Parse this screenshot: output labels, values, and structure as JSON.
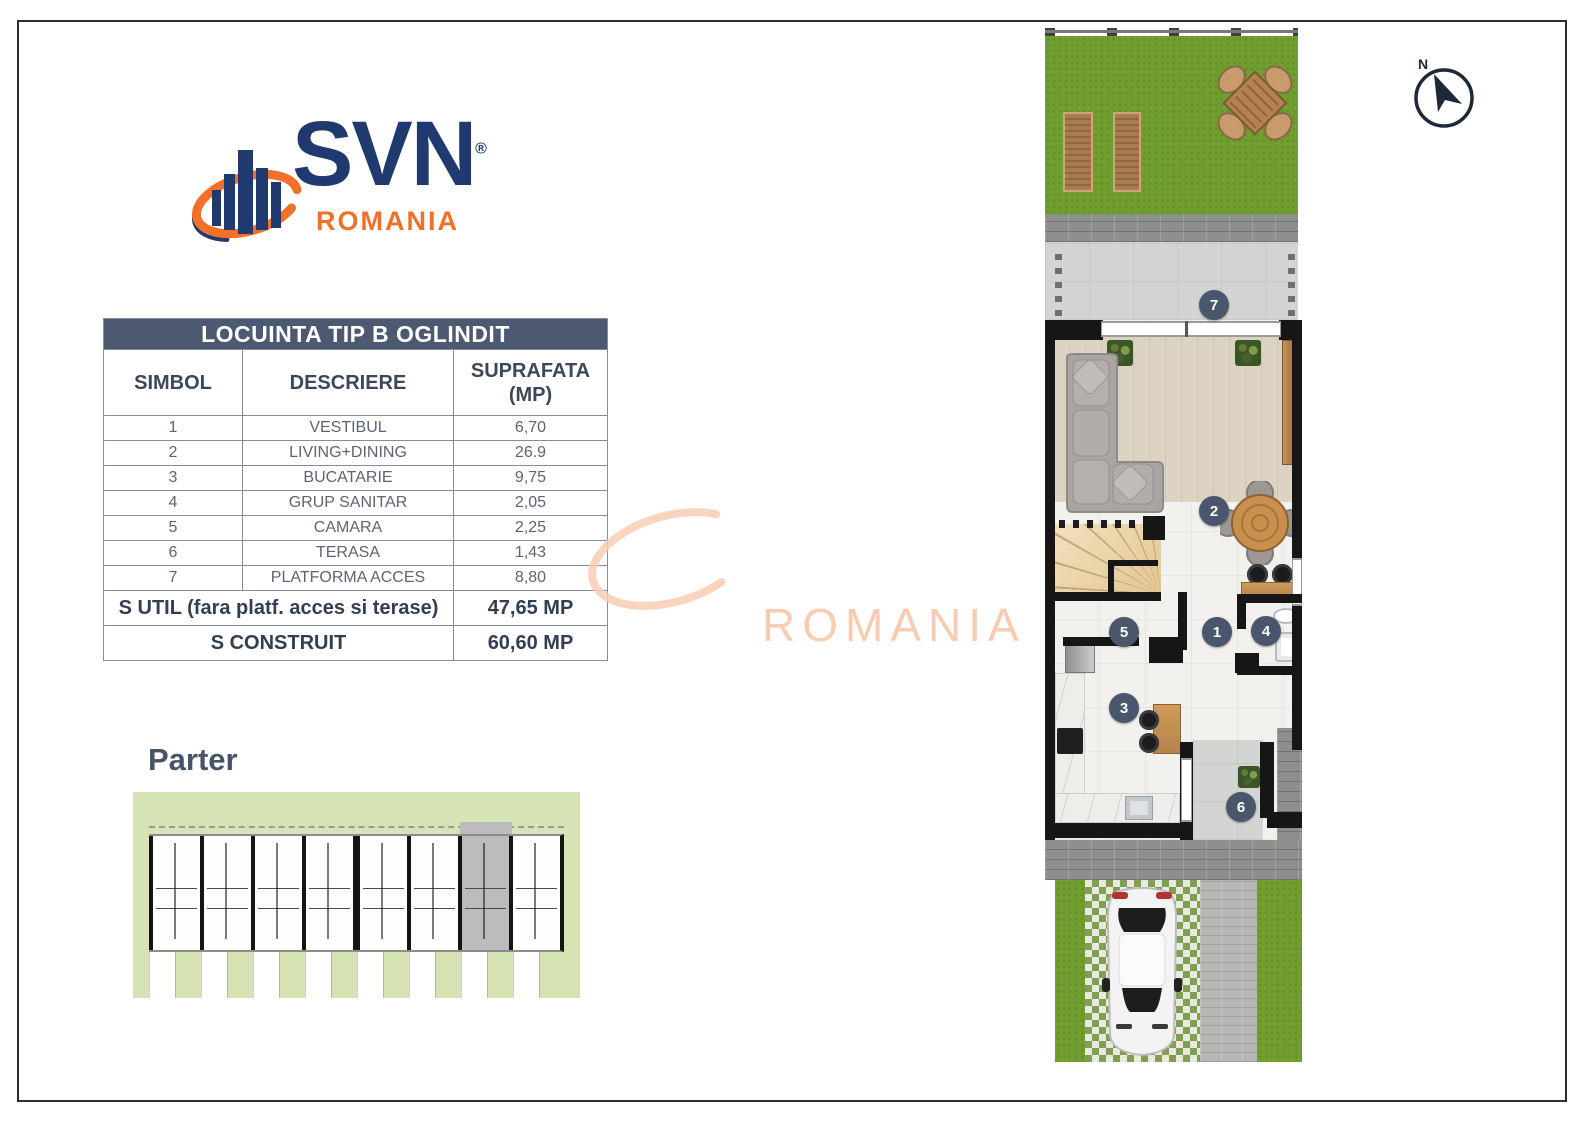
{
  "logo": {
    "brand": "SVN",
    "registered_mark": "®",
    "region": "ROMANIA",
    "navy": "#203a70",
    "orange": "#f2712a"
  },
  "table": {
    "title": "LOCUINTA TIP B OGLINDIT",
    "columns": {
      "c1": "SIMBOL",
      "c2": "DESCRIERE",
      "c3_line1": "SUPRAFATA",
      "c3_line2": "(MP)"
    },
    "rows": [
      {
        "simbol": "1",
        "descriere": "VESTIBUL",
        "suprafata": "6,70"
      },
      {
        "simbol": "2",
        "descriere": "LIVING+DINING",
        "suprafata": "26.9"
      },
      {
        "simbol": "3",
        "descriere": "BUCATARIE",
        "suprafata": "9,75"
      },
      {
        "simbol": "4",
        "descriere": "GRUP SANITAR",
        "suprafata": "2,05"
      },
      {
        "simbol": "5",
        "descriere": "CAMARA",
        "suprafata": "2,25"
      },
      {
        "simbol": "6",
        "descriere": "TERASA",
        "suprafata": "1,43"
      },
      {
        "simbol": "7",
        "descriere": "PLATFORMA ACCES",
        "suprafata": "8,80"
      }
    ],
    "summary": [
      {
        "label": "S UTIL (fara platf. acces si terase)",
        "value": "47,65 MP"
      },
      {
        "label": "S CONSTRUIT",
        "value": "60,60 MP"
      }
    ],
    "header_bg": "#4d5971"
  },
  "floor_label": "Parter",
  "watermark": {
    "text": "ROMANIA",
    "color": "#f8cbb2"
  },
  "compass": {
    "label": "N"
  },
  "floor_plan": {
    "marker_color": "#49566b",
    "markers": [
      {
        "number": "7",
        "x": 169,
        "y": 277
      },
      {
        "number": "2",
        "x": 169,
        "y": 483
      },
      {
        "number": "1",
        "x": 172,
        "y": 604
      },
      {
        "number": "4",
        "x": 221,
        "y": 603
      },
      {
        "number": "5",
        "x": 79,
        "y": 604
      },
      {
        "number": "3",
        "x": 79,
        "y": 680
      },
      {
        "number": "6",
        "x": 196,
        "y": 779
      }
    ]
  },
  "site_plan": {
    "units": 8,
    "highlighted_unit_index": 7,
    "sage": "#d6e4b5"
  }
}
